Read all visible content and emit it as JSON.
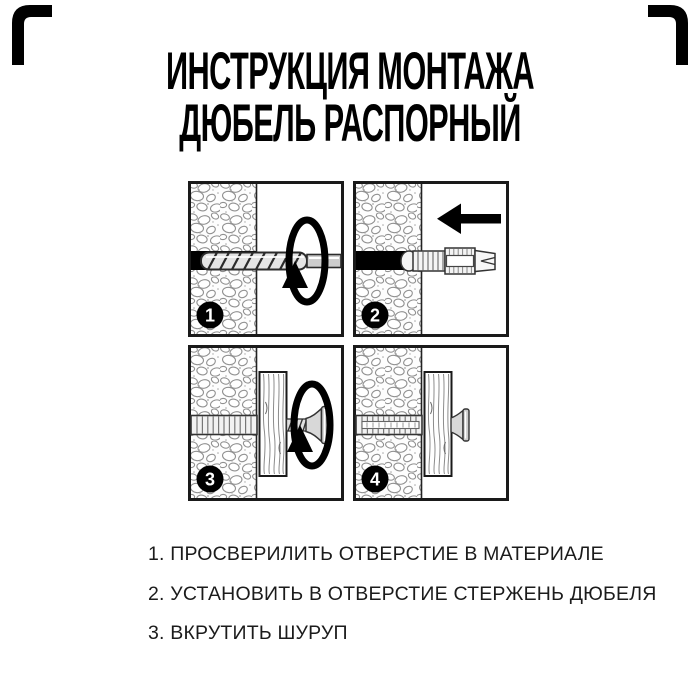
{
  "title": {
    "line1": "ИНСТРУКЦИЯ МОНТАЖА",
    "line2": "ДЮБЕЛЬ РАСПОРНЫЙ"
  },
  "panels": [
    {
      "number": "1"
    },
    {
      "number": "2"
    },
    {
      "number": "3"
    },
    {
      "number": "4"
    }
  ],
  "steps": [
    "1. ПРОСВЕРИЛИТЬ ОТВЕРСТИЕ В МАТЕРИАЛЕ",
    "2. УСТАНОВИТЬ В ОТВЕРСТИЕ СТЕРЖЕНЬ ДЮБЕЛЯ",
    "3. ВКРУТИТЬ ШУРУП"
  ],
  "colors": {
    "ink": "#000000",
    "background": "#ffffff"
  }
}
